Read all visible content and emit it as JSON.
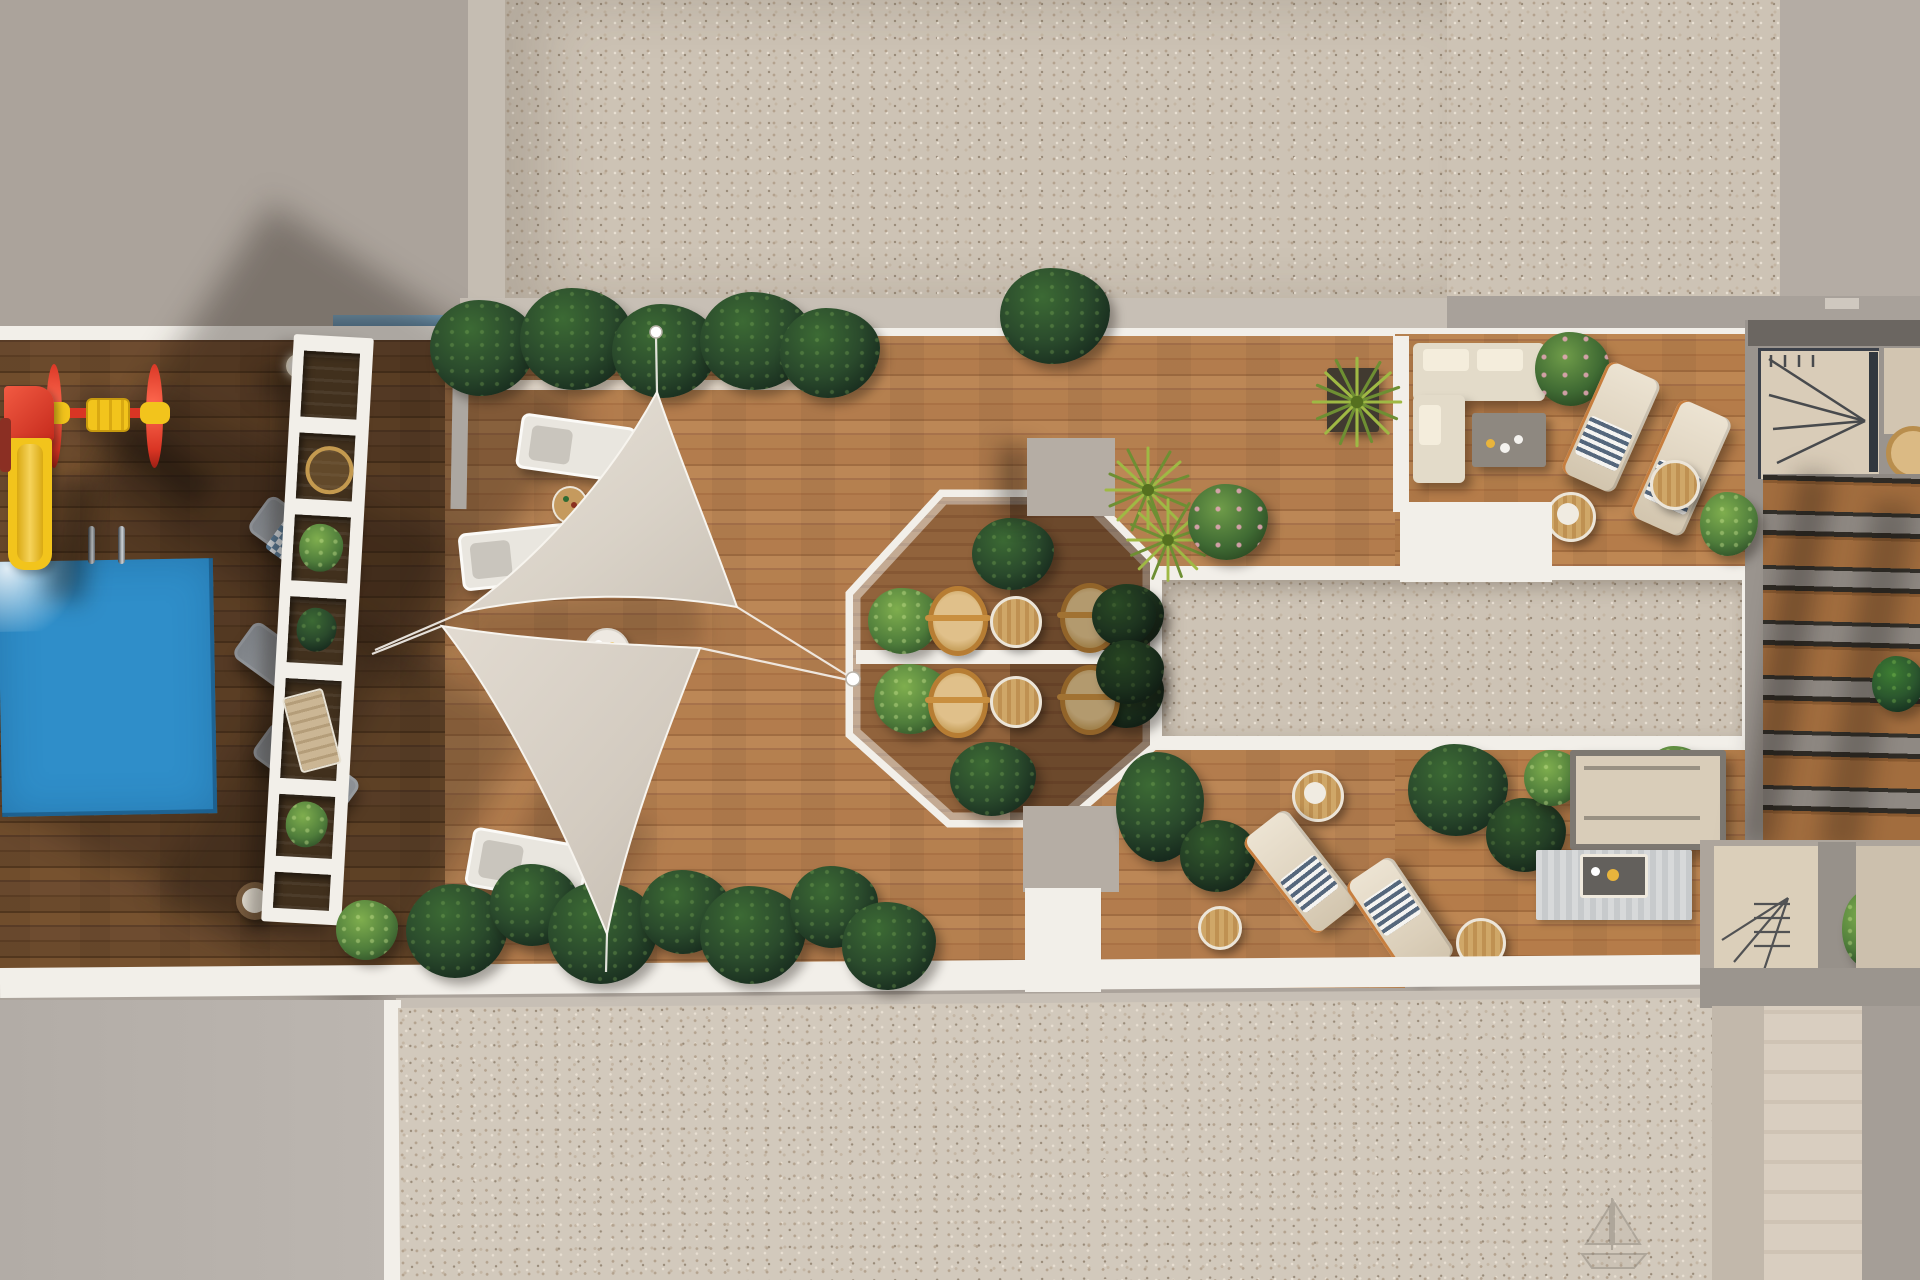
{
  "scene": {
    "type": "3d-architectural-render",
    "view": "top-down-aerial",
    "subject": "Rooftop amenity terrace of a residential building with pool, playground, shade sails, octagonal dining pavilion and lounge decks",
    "visible_text": "none",
    "areas": [
      {
        "id": "playground",
        "label": "children playground with slide and roller spinner"
      },
      {
        "id": "pool",
        "label": "swimming pool with ladder"
      },
      {
        "id": "pergola",
        "label": "white slatted pergola walkway with planters and deck chairs"
      },
      {
        "id": "shade-sails",
        "label": "two triangular fabric shade sails over timber deck"
      },
      {
        "id": "octagon-pavilion",
        "label": "octagonal dining pavilion with rattan chairs, round tables and shrubs"
      },
      {
        "id": "gravel-strip",
        "label": "white-framed gravel skylight strip"
      },
      {
        "id": "lounge-area",
        "label": "corner sofa lounge with coffee table and sun loungers"
      },
      {
        "id": "cabana",
        "label": "shaded cabana seat with rug and side table"
      },
      {
        "id": "neighbor-roof",
        "label": "adjacent roof with louvered timber slats and staircases"
      },
      {
        "id": "gravel-roofs",
        "label": "speckled gravel roof fields top and bottom"
      }
    ],
    "furniture_counts": {
      "gray_loungers": 3,
      "white_loungers": 3,
      "cream_loungers": 4,
      "rattan_chairs": 4,
      "round_tables": 9,
      "sofas": 1,
      "cabanas": 1
    },
    "planting": {
      "dark_tropical_clusters": 14,
      "light_shrubs": 6,
      "rose_bushes": 2,
      "yucca_plants": 3
    }
  },
  "palette": {
    "bg_base": "#aba39b",
    "wall_gray": "#a7a099",
    "shadow_blue": "#84868b",
    "gravel_base": "#cdc3b5",
    "tan_band": "#c7bfb5",
    "white_trim": "#f2efe9",
    "wood_lit": "#b07a4a",
    "wood_dark": "#6e4a2e",
    "pool_blue": "#2f8ec9",
    "pool_sparkle": "#8ed0ef",
    "sail_fabric": "#ddd6cb",
    "plant_dark": "#203428",
    "plant_light": "#4f7d3b",
    "play_red": "#e03a2c",
    "play_yellow": "#f2c41c",
    "rattan": "#c98f3f",
    "cream_fabric": "#e6ddcb",
    "gray_furniture": "#8e9296",
    "slat_wood": "#a26d3e",
    "roof_edge_dark": "#6b6661"
  }
}
